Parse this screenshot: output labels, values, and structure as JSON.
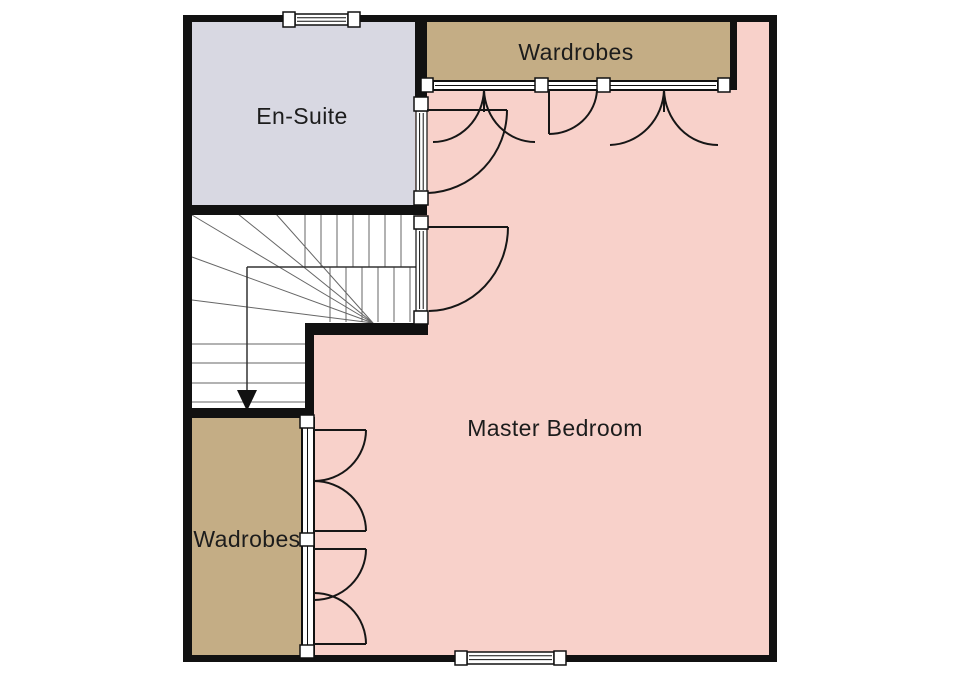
{
  "plan": {
    "type": "floorplan",
    "floor": "first-floor-master-suite"
  },
  "colors": {
    "bedroom": "#f8d1ca",
    "wardrobe": "#c4ad85",
    "ensuite": "#d8d8e2",
    "wall": "#111111",
    "stair_floor": "#ffffff",
    "frame_white": "#ffffff"
  },
  "rooms": {
    "master_bedroom": {
      "label": "Master Bedroom"
    },
    "ensuite": {
      "label": "En-Suite"
    },
    "wardrobes_top": {
      "label": "Wardrobes"
    },
    "wardrobes_left": {
      "label": "Wadrobes"
    }
  }
}
